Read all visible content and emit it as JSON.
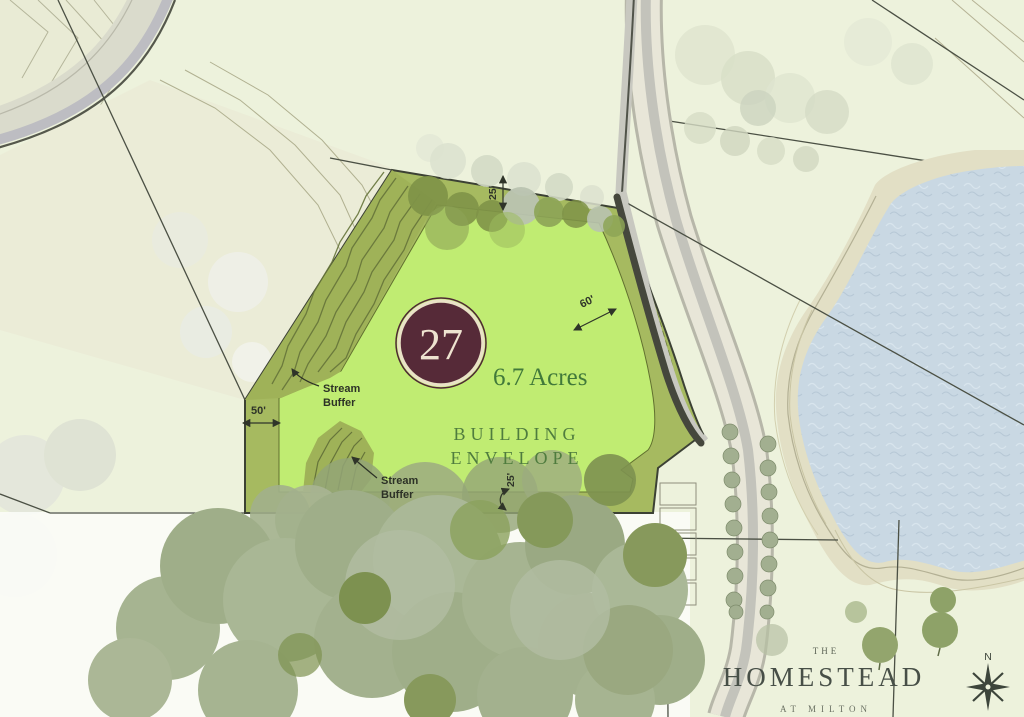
{
  "map": {
    "lot": {
      "number": "27",
      "acreage": "6.7 Acres",
      "envelope_line1": "BUILDING",
      "envelope_line2": "ENVELOPE",
      "stream_buffer_line1": "Stream",
      "stream_buffer_line2": "Buffer",
      "dim_top": "25'",
      "dim_right": "60'",
      "dim_left": "50'",
      "dim_bottom": "25'"
    },
    "branding": {
      "prefix": "THE",
      "name": "HOMESTEAD",
      "suffix": "AT MILTON"
    },
    "compass": {
      "north": "N"
    },
    "colors": {
      "background": "#edf2dc",
      "envelope_green": "#c0ec72",
      "setback_olive": "#a6ba60",
      "buffer_fill": "#9fb258",
      "buffer_hatch": "#66743a",
      "badge_maroon": "#562a38",
      "badge_text": "#eee3d0",
      "label_green": "#4f7c3e",
      "acreage_green": "#41793a",
      "dim_text": "#2f3429",
      "pond_blue": "#c9d8e3",
      "shore_tan": "#e2dfc5",
      "road_gray": "#d9dacb",
      "tree_sage": "#a6b491",
      "logo_gray": "#474f47"
    }
  }
}
